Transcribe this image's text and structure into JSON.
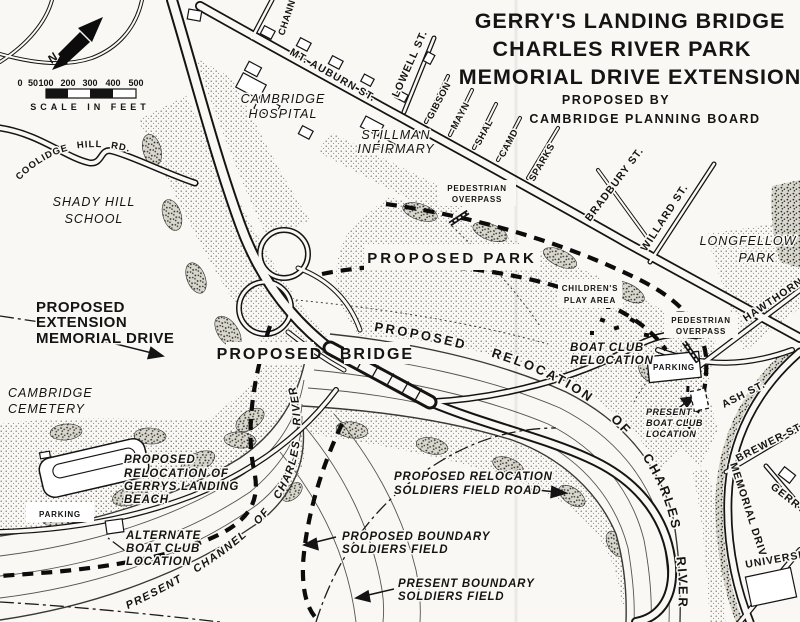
{
  "colors": {
    "paper": "#f9f8f4",
    "ink": "#141414"
  },
  "title": {
    "line1": "GERRY'S LANDING BRIDGE",
    "line2": "CHARLES RIVER PARK",
    "line3": "MEMORIAL DRIVE EXTENSION",
    "sub1": "PROPOSED BY",
    "sub2": "CAMBRIDGE PLANNING BOARD"
  },
  "scale": {
    "ticks": [
      "0",
      "50",
      "100",
      "200",
      "300",
      "400",
      "500"
    ],
    "caption": "SCALE IN FEET"
  },
  "north": {
    "label": "N"
  },
  "streets": {
    "channing_partial": "CHANN",
    "mt_auburn": "MT. AUBURN ST.",
    "lowell": "LOWELL ST.",
    "gibson": "GIBSON",
    "maynard_partial": "MAYN",
    "shaler_partial": "SHAL",
    "camden_partial": "CAMD",
    "sparks": "SPARKS",
    "bradbury": "BRADBURY ST.",
    "willard": "WILLARD ST.",
    "hawthorn": "HAWTHORN",
    "ash": "ASH ST.",
    "brewer": "BREWER ST.",
    "memorial_drive": "MEMORIAL DRIVE",
    "gerry": "GERRY",
    "university_partial": "UNIVERSIT",
    "coolidge_hill": "COOLIDGE HILL RD."
  },
  "places": {
    "cambridge_hospital": [
      "CAMBRIDGE",
      "HOSPITAL"
    ],
    "stillman_infirmary": [
      "STILLMAN",
      "INFIRMARY"
    ],
    "shady_hill_school": [
      "SHADY HILL",
      "SCHOOL"
    ],
    "longfellow_park": [
      "LONGFELLOW",
      "PARK"
    ],
    "cambridge_cemetery": [
      "CAMBRIDGE",
      "CEMETERY"
    ]
  },
  "annotations": {
    "pedestrian_overpass": [
      "PEDESTRIAN",
      "OVERPASS"
    ],
    "proposed_park": "PROPOSED PARK",
    "childrens_play_area": [
      "CHILDREN'S",
      "PLAY AREA"
    ],
    "boat_club_relocation": [
      "BOAT CLUB",
      "RELOCATION"
    ],
    "proposed_bridge": [
      "PROPOSED",
      "BRIDGE"
    ],
    "proposed_extension": [
      "PROPOSED",
      "EXTENSION",
      "MEMORIAL DRIVE"
    ],
    "gerrys_landing_beach": [
      "PROPOSED",
      "RELOCATION OF",
      "GERRYS LANDING",
      "BEACH"
    ],
    "parking": "PARKING",
    "alternate_boat_club": [
      "ALTERNATE",
      "BOAT CLUB",
      "LOCATION"
    ],
    "present_boat_club": [
      "PRESENT",
      "BOAT CLUB",
      "LOCATION"
    ],
    "soldiers_field_road_relocation": [
      "PROPOSED RELOCATION",
      "SOLDIERS FIELD ROAD"
    ],
    "proposed_boundary_soldiers_field": [
      "PROPOSED BOUNDARY",
      "SOLDIERS FIELD"
    ],
    "present_boundary_soldiers_field": [
      "PRESENT BOUNDARY",
      "SOLDIERS FIELD"
    ],
    "relocated_river": "PROPOSED RELOCATION OF CHARLES RIVER",
    "present_channel": "PRESENT CHANNEL OF CHARLES RIVER"
  }
}
